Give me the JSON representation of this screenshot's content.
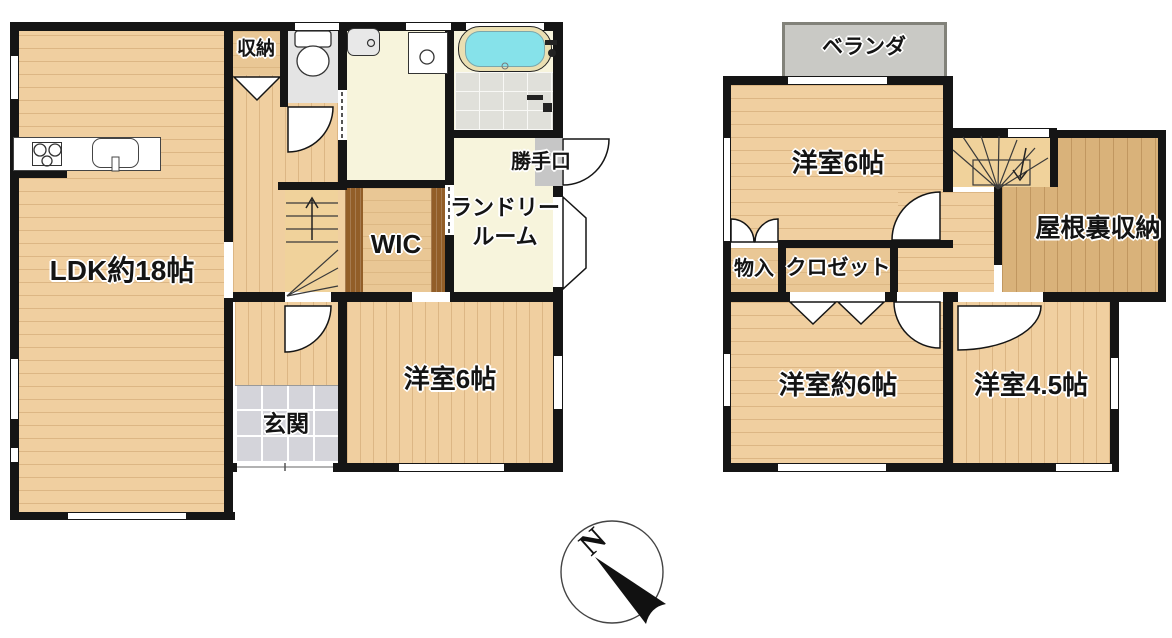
{
  "floor1": {
    "ldk": "LDK約18帖",
    "storage": "収納",
    "laundry_line1": "ランドリー",
    "laundry_line2": "ルーム",
    "wic": "WIC",
    "back_door": "勝手口",
    "entrance": "玄関",
    "bedroom6": "洋室6帖"
  },
  "floor2": {
    "veranda": "ベランダ",
    "bedroom6": "洋室6帖",
    "attic": "屋根裏収納",
    "storage": "物入",
    "closet": "クロゼット",
    "bedroom6_approx": "洋室約6帖",
    "bedroom45": "洋室4.5帖"
  },
  "compass": {
    "north": "N"
  },
  "colors": {
    "wood_floor": "#f0cfa0",
    "attic_wood": "#d9b27a",
    "closet_tan": "#e9c795",
    "wall": "#151515",
    "bathtub": "#86e2ea",
    "veranda_gray": "#c9c9c5",
    "washroom_cream": "#f7f4dc",
    "genkan_tile": "#d4d4da"
  }
}
